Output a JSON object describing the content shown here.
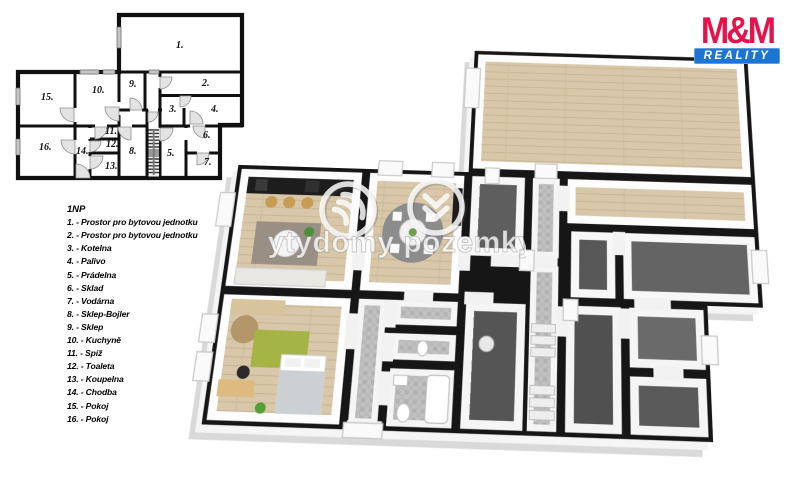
{
  "logo": {
    "brand": "M&M",
    "subtitle": "REALITY",
    "brand_color": "#e5134b",
    "bar_color": "#1d74d2"
  },
  "watermark": {
    "text": "bytydomy pozemky"
  },
  "legend": {
    "title": "1NP",
    "items": [
      "1. - Prostor pro bytovou jednotku",
      "2. - Prostor pro bytovou jednotku",
      "3. - Kotelna",
      "4. - Palivo",
      "5. - Prádelna",
      "6. - Sklad",
      "7. - Vodárna",
      "8. - Sklep-Bojler",
      "9. - Sklep",
      "10. - Kuchyně",
      "11. - Spíž",
      "12. - Toaleta",
      "13. - Koupelna",
      "14. - Chodba",
      "15. - Pokoj",
      "16. - Pokoj"
    ]
  },
  "schematic": {
    "labels": [
      "1.",
      "2.",
      "3.",
      "4.",
      "5.",
      "6.",
      "7.",
      "8.",
      "9.",
      "10.",
      "11.",
      "12.",
      "13.",
      "14.",
      "15.",
      "16."
    ]
  },
  "colors": {
    "wall": "#141414",
    "wood_floor": "#d8c8a9",
    "dark_floor": "#5e5e5e",
    "tile_floor": "#bfbfbf",
    "slab": "#f5f5f5",
    "rug_green": "#a4b445",
    "rug_gray": "#998f85"
  }
}
